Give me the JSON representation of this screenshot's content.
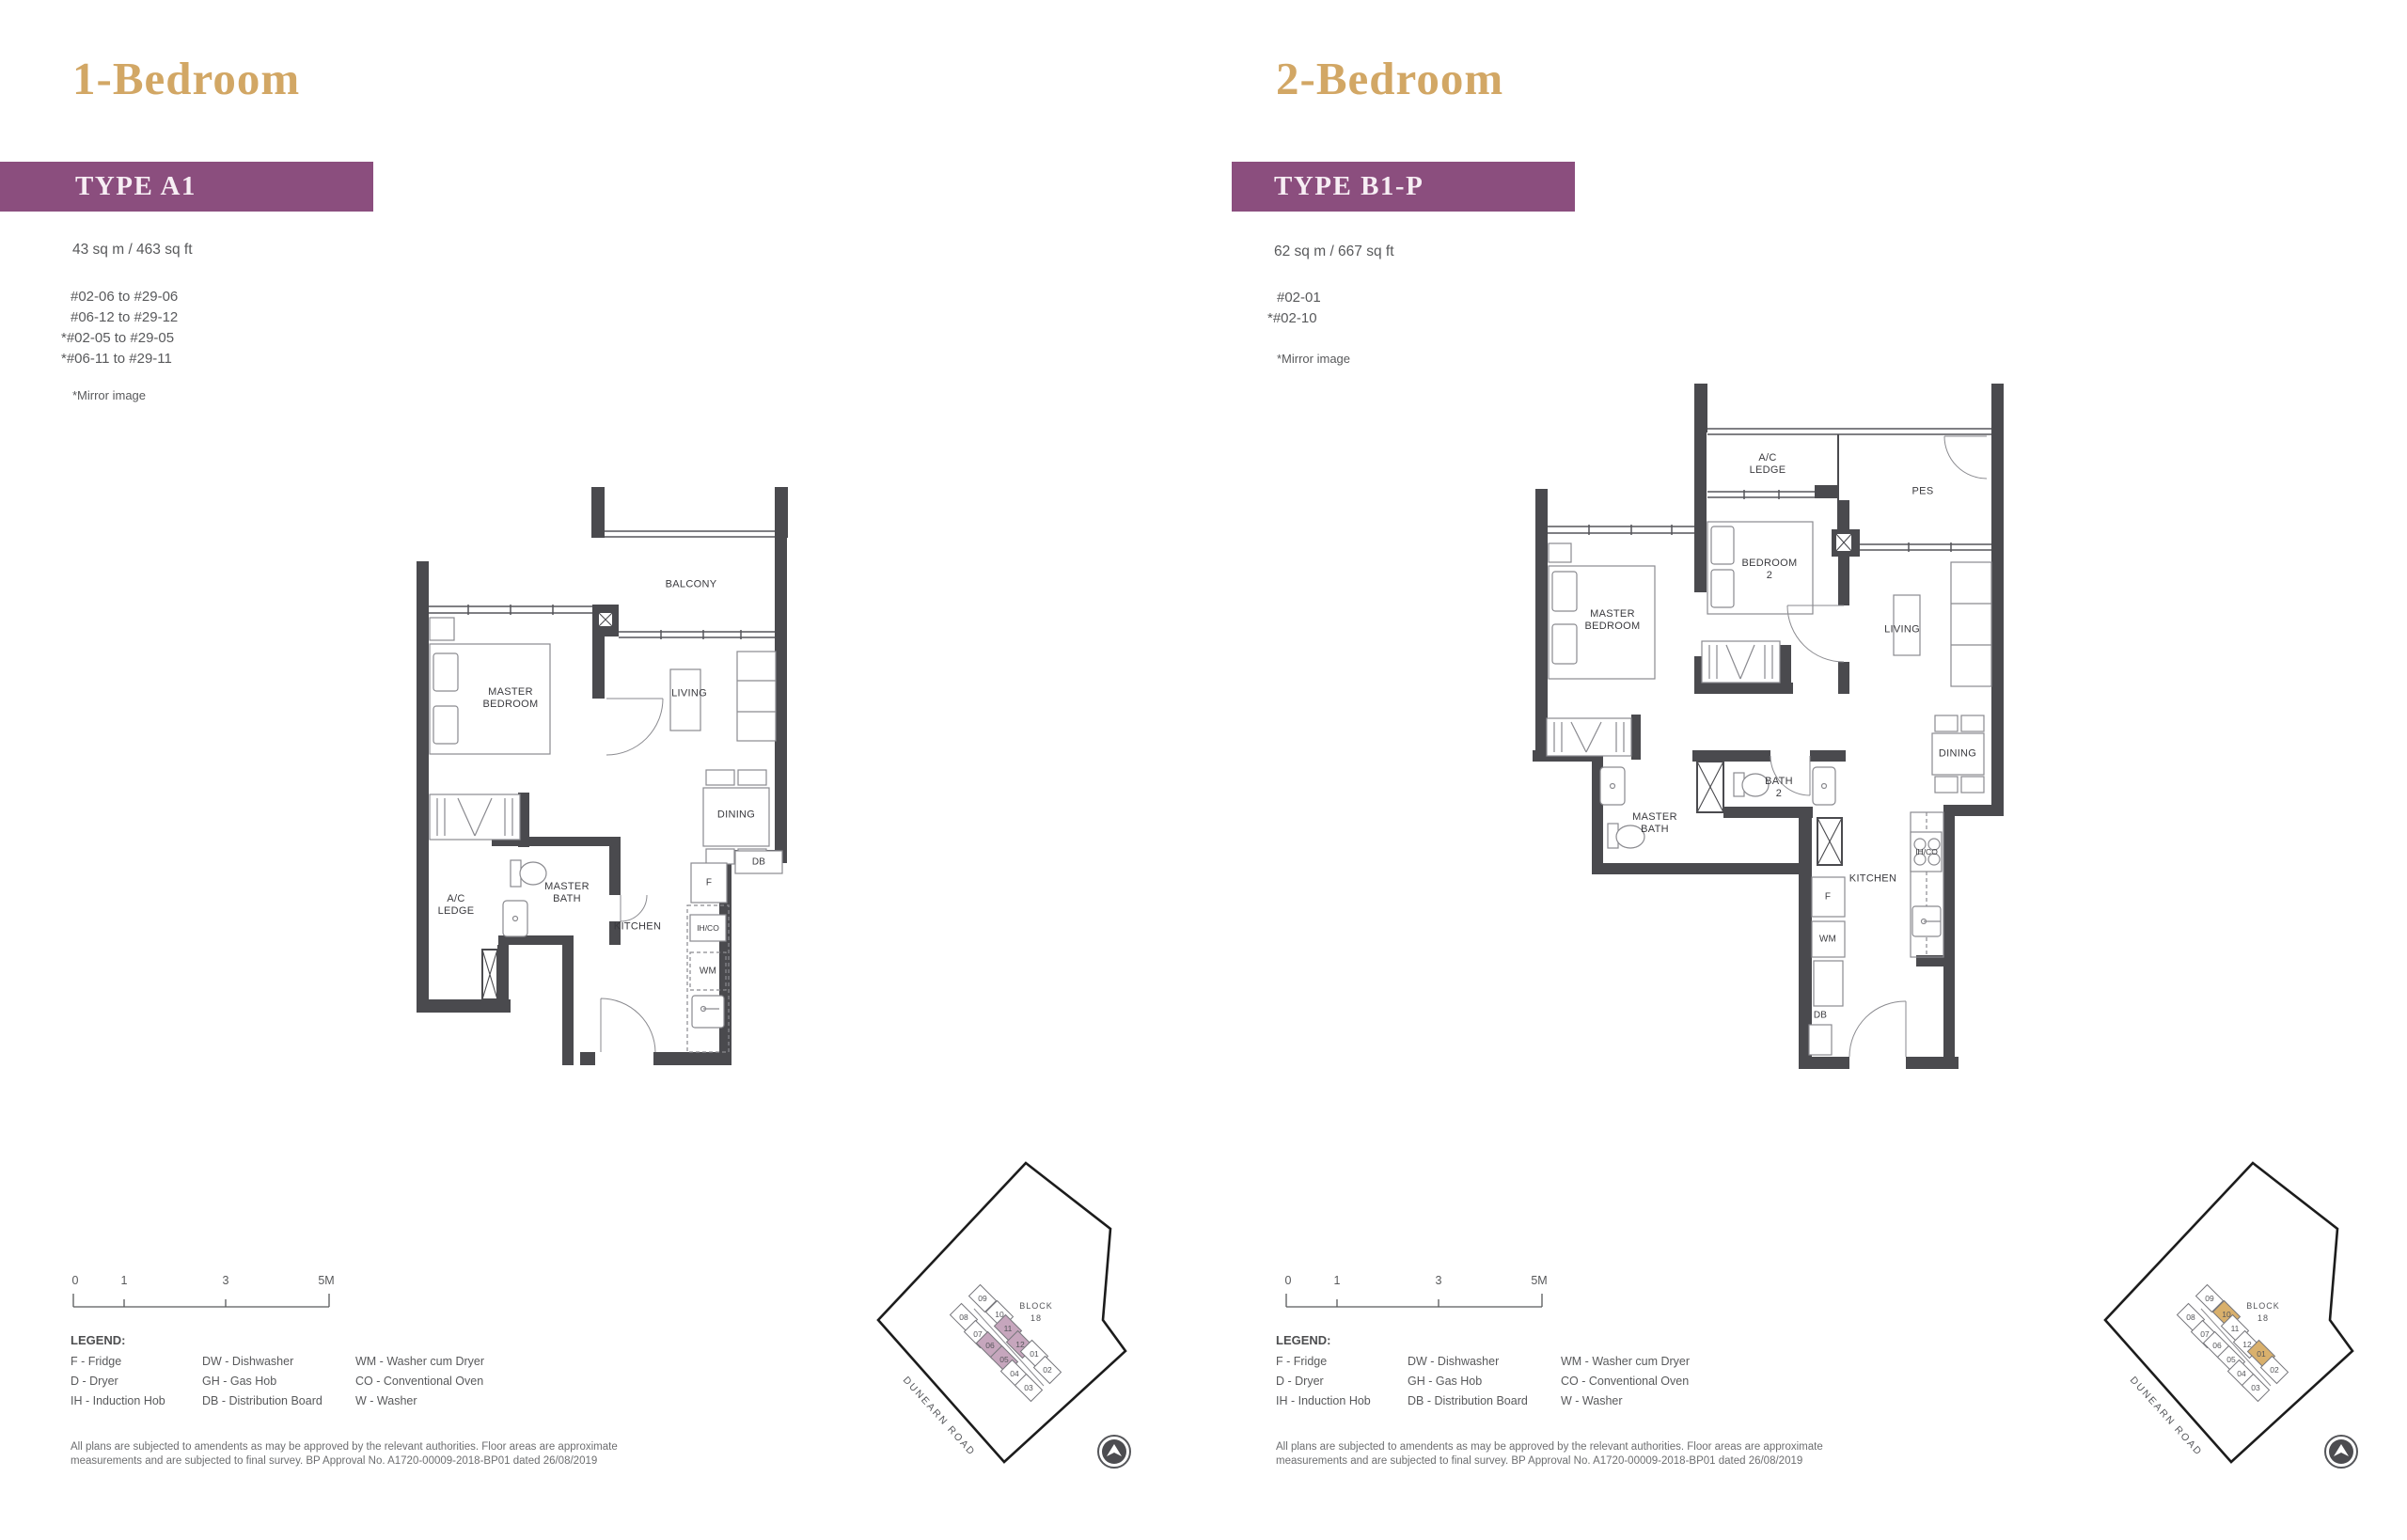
{
  "left": {
    "title": "1-Bedroom",
    "type": "TYPE A1",
    "area": "43 sq m / 463 sq ft",
    "units": [
      "#02-06 to #29-06",
      "#06-12 to #29-12",
      "*#02-05 to #29-05",
      "*#06-11 to #29-11"
    ],
    "mirror_note": "*Mirror image",
    "rooms": {
      "balcony": "BALCONY",
      "master_bedroom": "MASTER\nBEDROOM",
      "living": "LIVING",
      "dining": "DINING",
      "ac_ledge": "A/C\nLEDGE",
      "master_bath": "MASTER\nBATH",
      "kitchen": "KITCHEN",
      "fridge": "F",
      "db": "DB",
      "ihco": "IH/CO",
      "wm": "WM"
    }
  },
  "right": {
    "title": "2-Bedroom",
    "type": "TYPE B1-P",
    "area": "62 sq m / 667 sq ft",
    "units": [
      "#02-01",
      "*#02-10"
    ],
    "mirror_note": "*Mirror image",
    "rooms": {
      "ac_ledge": "A/C\nLEDGE",
      "pes": "PES",
      "master_bedroom": "MASTER\nBEDROOM",
      "bedroom2": "BEDROOM\n2",
      "living": "LIVING",
      "dining": "DINING",
      "master_bath": "MASTER\nBATH",
      "bath2": "BATH\n2",
      "kitchen": "KITCHEN",
      "fridge": "F",
      "wm": "WM",
      "db": "DB",
      "ihco": "IH/CO"
    }
  },
  "scale_bar": {
    "t0": "0",
    "t1": "1",
    "t2": "3",
    "t3": "5M"
  },
  "legend": {
    "title": "LEGEND:",
    "col1": [
      "F - Fridge",
      "D - Dryer",
      "IH - Induction Hob"
    ],
    "col2": [
      "DW - Dishwasher",
      "GH - Gas Hob",
      "DB - Distribution Board"
    ],
    "col3": [
      "WM - Washer cum Dryer",
      "CO - Conventional Oven",
      "W - Washer"
    ]
  },
  "disclaimer": "All plans are subjected to amendents as may be approved by the relevant authorities. Floor areas are approximate\nmeasurements and are subjected to final survey. BP Approval No. A1720-00009-2018-BP01 dated 26/08/2019",
  "site_plan": {
    "block_line1": "BLOCK",
    "block_line2": "18",
    "road": "DUNEARN ROAD",
    "units": [
      "09",
      "10",
      "08",
      "07",
      "06",
      "11",
      "12",
      "05",
      "01",
      "04",
      "02",
      "03"
    ],
    "left_highlighted": [
      "05",
      "06",
      "11",
      "12"
    ],
    "right_highlighted": [
      "01",
      "10"
    ]
  }
}
